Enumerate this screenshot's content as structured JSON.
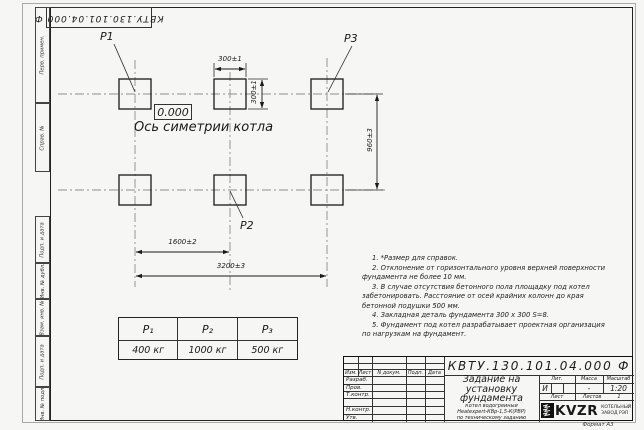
{
  "sheet": {
    "designation": "КВТУ.130.101.04.000 Ф",
    "format_label": "Формат А3"
  },
  "margin_boxes": [
    {
      "label": "Перв. примен."
    },
    {
      "label": "Справ. №"
    },
    {
      "label": "Подп. и дата"
    },
    {
      "label": "Инв. № дубл."
    },
    {
      "label": "Взам. инв. №"
    },
    {
      "label": "Подп. и дата"
    },
    {
      "label": "Инв. № подл."
    }
  ],
  "drawing": {
    "pad_labels": {
      "p1": "P1",
      "p2": "P2",
      "p3": "P3"
    },
    "level_mark": "0.000",
    "axis_caption": "Ось симетрии котла",
    "dims": {
      "pad_w": "300±1",
      "pad_h": "300±1",
      "rows": "960±3",
      "half": "1600±2",
      "full": "3200±3"
    }
  },
  "notes": [
    "1. *Размер для справок.",
    "2. Отклонение от горизонтального уровня верхней поверхности фундамента не более 10 мм.",
    "3. В случае отсутствия бетонного пола площадку под котел забетонировать. Расстояние от осей крайних колонн до края бетонной подушки 500 мм.",
    "4. Закладная деталь фундамента 300 х 300 S=8.",
    "5. Фундамент под котел разрабатывает проектная организация по нагрузкам на фундамент."
  ],
  "load_table": {
    "headers": [
      "P₁",
      "P₂",
      "P₃"
    ],
    "values": [
      "400 кг",
      "1000 кг",
      "500 кг"
    ]
  },
  "title_block": {
    "designation": "КВТУ.130.101.04.000 Ф",
    "doc_title_lines": [
      "Задание на",
      "установку",
      "фундамента"
    ],
    "product_lines": [
      "Котел водогрейный",
      "Heatexpert-КВр-1,5-К(РВР)",
      "по техническому заданию"
    ],
    "header_cols": [
      "Изм.",
      "Лист",
      "N докум.",
      "Подп.",
      "Дата"
    ],
    "rows": [
      "Разраб.",
      "Пров.",
      "Т.контр.",
      "",
      "Н.контр.",
      "Утв."
    ],
    "lit_label": "Лит.",
    "lit_value": "И",
    "mass_label": "Масса",
    "mass_value": "-",
    "scale_label": "Масштаб",
    "scale_value": "1:20",
    "sheet_label": "Лист",
    "sheets_label": "Листов",
    "sheets_value": "1",
    "company": {
      "name": "KVZR",
      "line1": "КОТЕЛЬНЫЙ",
      "line2": "ЗАВОД РЭП"
    }
  }
}
